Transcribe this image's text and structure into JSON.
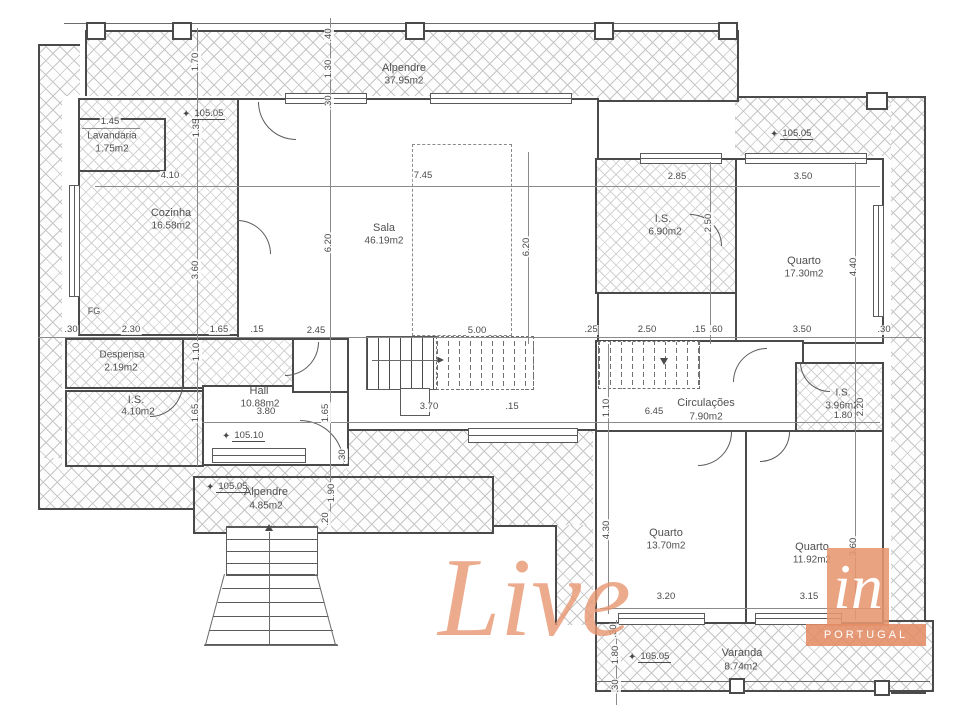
{
  "rooms": {
    "alpendre_top": {
      "name": "Alpendre",
      "area": "37.95m2"
    },
    "lavandaria": {
      "name": "Lavandaria",
      "area": "1.75m2"
    },
    "cozinha": {
      "name": "Cozinha",
      "area": "16.58m2"
    },
    "sala": {
      "name": "Sala",
      "area": "46.19m2"
    },
    "is_suite": {
      "name": "I.S.",
      "area": "6.90m2"
    },
    "quarto_1": {
      "name": "Quarto",
      "area": "17.30m2"
    },
    "despensa": {
      "name": "Despensa",
      "area": "2.19m2"
    },
    "is_social": {
      "name": "I.S.",
      "area": "4.10m2"
    },
    "hall": {
      "name": "Hall",
      "area": "10.88m2"
    },
    "circulacoes": {
      "name": "Circulações",
      "area": "7.90m2"
    },
    "is_quartos": {
      "name": "I.S.",
      "area": "3.96m2"
    },
    "alpendre_entrada": {
      "name": "Alpendre",
      "area": "4.85m2"
    },
    "quarto_2": {
      "name": "Quarto",
      "area": "13.70m2"
    },
    "quarto_3": {
      "name": "Quarto",
      "area": "11.92m2"
    },
    "varanda": {
      "name": "Varanda",
      "area": "8.74m2"
    }
  },
  "fixtures": {
    "fg_label": "FG"
  },
  "levels": {
    "kitchen": "105.05",
    "porch_right": "105.05",
    "hall_front": "105.10",
    "entrance": "105.05",
    "varanda": "105.05"
  },
  "dims_h": {
    "a": "1.45",
    "b": "4.10",
    "c": "7.45",
    "d": "2.85",
    "e": "3.50",
    "f": ".30",
    "g": "2.30",
    "h": "1.65",
    "i": ".15",
    "j": "2.45",
    "k": "5.00",
    "l": ".25",
    "m": "2.50",
    "n": ".15",
    "o": ".60",
    "p": "3.50",
    "q": ".30",
    "r": "3.80",
    "s": "3.70",
    "t": ".15",
    "u": "6.45",
    "v": "1.80",
    "w": "3.20",
    "x": "3.15"
  },
  "dims_v": {
    "a": "1.70",
    "b": "1.35",
    "c": "3.60",
    "d": "1.10",
    "e": "1.65",
    "f": ".40",
    "g": "1.30",
    "h": ".30",
    "i": "6.20",
    "j": "1.65",
    "k": ".30",
    "l": "1.90",
    "m": ".20",
    "n": "6.20",
    "o": "1.10",
    "p": "4.30",
    "q": "2.50",
    "r": "4.40",
    "s": "3.60",
    "t": ".30",
    "u": "1.80",
    "v": ".30",
    "w": "2.20"
  },
  "logo": {
    "word": "Live",
    "suffix": "in",
    "country": "PORTUGAL"
  },
  "accent_color": "#e79670",
  "line_color": "#4a4a4a"
}
